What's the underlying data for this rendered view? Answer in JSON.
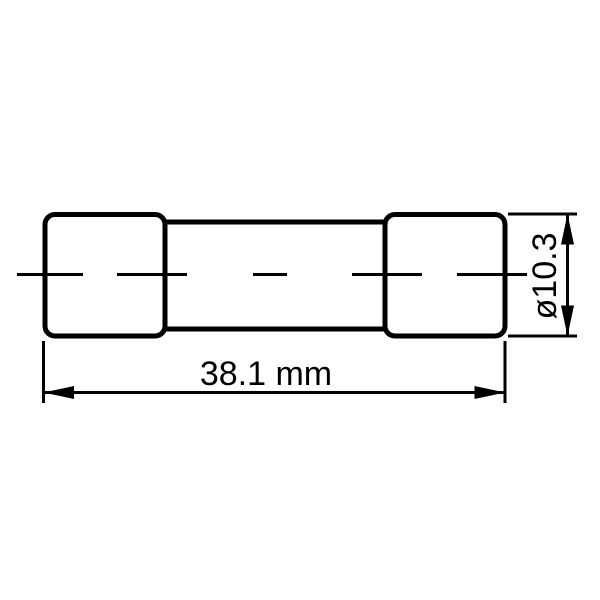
{
  "drawing": {
    "subject": "cartridge fuse outline drawing, side view",
    "colors": {
      "line": "#000000",
      "background": "#ffffff"
    },
    "dimensions": {
      "length": {
        "label": "38.1 mm",
        "value": 38.1,
        "unit": "mm"
      },
      "diameter": {
        "label": "ø10.3",
        "value": 10.3,
        "symbol": "ø"
      }
    }
  }
}
